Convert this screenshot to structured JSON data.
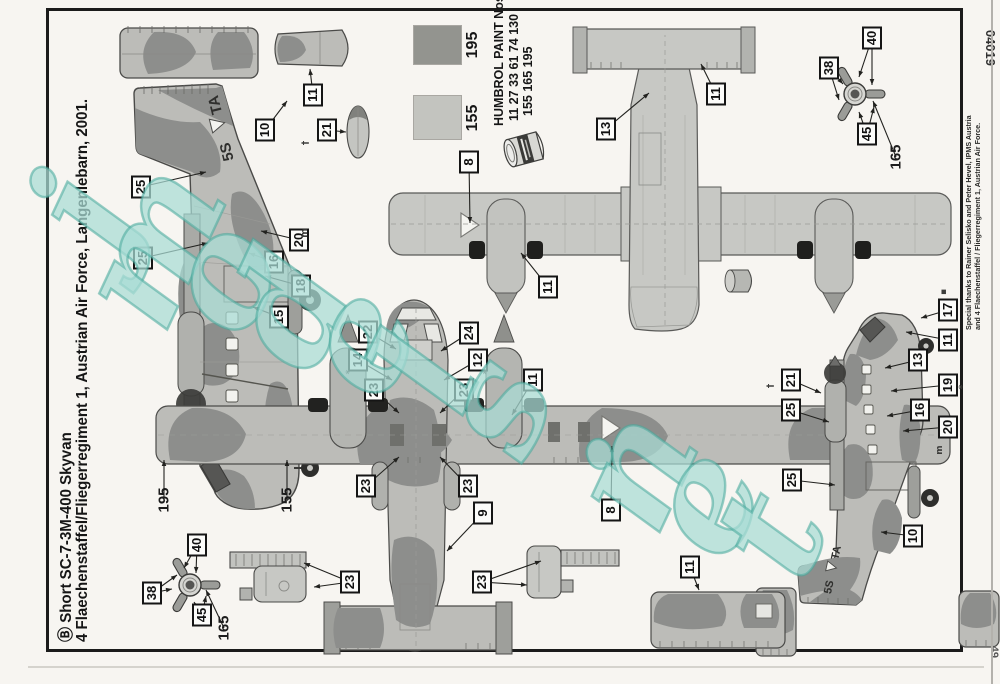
{
  "page": {
    "title_line1": "Ⓑ Short SC-7-3M-400 Skyvan",
    "title_line2": "4 Flaechenstaffel/Fliegerregiment 1, Austrian Air Force, Langenlebarn, 2001.",
    "kit_number": "04019",
    "page_number": "49",
    "registration": {
      "prefix": "5S",
      "suffix": "TA"
    }
  },
  "credits": {
    "line1": "Special thanks to Rainer Selisko and Peter Hevel, IPMS Austria",
    "line2": "and 4 Flaechenstaffel / Fliegerregiment 1, Austrian Air Force."
  },
  "paints": {
    "header": "HUMBROL PAINT Nos.",
    "numbers_line1": "11 27 33 61 74 130",
    "numbers_line2": "155 165 195",
    "swatches": [
      {
        "code": "155",
        "color": "#c3c4bf"
      },
      {
        "code": "195",
        "color": "#93948f"
      }
    ]
  },
  "watermark": {
    "text": "jmodels.net",
    "fill": "#c9ede7",
    "stroke": "#49aa9d"
  },
  "colors": {
    "paper": "#f7f5f1",
    "line": "#1b1b1b",
    "camo_dark": "#8d8e8c",
    "camo_light": "#bcbcb8",
    "underside_gray": "#c7c8c4",
    "boot_black": "#1f1f1d"
  },
  "mark_glyphs": {
    "anchor": "†",
    "sparkle": "*",
    "square": "▪",
    "m": "m"
  },
  "marks": [
    {
      "glyph": "anchor",
      "x": 541,
      "y": 306
    },
    {
      "glyph": "anchor",
      "x": 298,
      "y": 771
    },
    {
      "glyph": "sparkle",
      "x": 297,
      "y": 963
    },
    {
      "glyph": "square",
      "x": 392,
      "y": 944
    },
    {
      "glyph": "sparkle",
      "x": 312,
      "y": 350
    },
    {
      "glyph": "sparkle",
      "x": 312,
      "y": 487
    },
    {
      "glyph": "m",
      "x": 451,
      "y": 305
    },
    {
      "glyph": "m",
      "x": 234,
      "y": 940
    }
  ],
  "callout_groups": [
    {
      "name": "port-side-view",
      "items": [
        {
          "label": "10",
          "x": 554,
          "y": 265,
          "leads": [
            [
              583,
              287
            ]
          ]
        },
        {
          "label": "25",
          "x": 497,
          "y": 141,
          "leads": [
            [
              512,
              206
            ]
          ]
        },
        {
          "label": "25",
          "x": 426,
          "y": 143,
          "leads": [
            [
              441,
              208
            ]
          ]
        },
        {
          "label": "15",
          "x": 367,
          "y": 279,
          "leads": [
            [
              377,
              253
            ]
          ]
        },
        {
          "label": "16",
          "x": 422,
          "y": 274,
          "leads": [
            [
              431,
              249
            ]
          ]
        },
        {
          "label": "18",
          "x": 398,
          "y": 301,
          "leads": [
            [
              408,
              265
            ]
          ]
        },
        {
          "label": "20",
          "x": 444,
          "y": 299,
          "leads": [
            [
              453,
              261
            ]
          ]
        },
        {
          "label": "21",
          "x": 554,
          "y": 327,
          "leads": [
            [
              552,
              346
            ]
          ]
        },
        {
          "label": "11",
          "x": 589,
          "y": 313,
          "leads": [
            [
              615,
              310
            ]
          ]
        }
      ]
    },
    {
      "name": "underside-view",
      "items": [
        {
          "label": "13",
          "x": 555,
          "y": 606,
          "leads": [
            [
              591,
              649
            ]
          ]
        },
        {
          "label": "11",
          "x": 590,
          "y": 716,
          "leads": [
            [
              620,
              701
            ]
          ]
        },
        {
          "label": "8",
          "x": 522,
          "y": 469,
          "leads": [
            [
              461,
              470
            ]
          ]
        },
        {
          "label": "11",
          "x": 397,
          "y": 548,
          "leads": [
            [
              431,
              521
            ]
          ]
        }
      ]
    },
    {
      "name": "top-view",
      "items": [
        {
          "label": "22",
          "x": 352,
          "y": 368,
          "leads": [
            [
              335,
              396
            ]
          ]
        },
        {
          "label": "14",
          "x": 324,
          "y": 358,
          "leads": [
            [
              304,
              392
            ]
          ]
        },
        {
          "label": "24",
          "x": 351,
          "y": 469,
          "leads": [
            [
              333,
              441
            ]
          ]
        },
        {
          "label": "12",
          "x": 324,
          "y": 478,
          "leads": [
            [
              304,
              444
            ]
          ]
        },
        {
          "label": "23",
          "x": 294,
          "y": 374,
          "leads": [
            [
              271,
              399
            ]
          ]
        },
        {
          "label": "23",
          "x": 294,
          "y": 464,
          "leads": [
            [
              271,
              440
            ]
          ]
        },
        {
          "label": "23",
          "x": 198,
          "y": 366,
          "leads": [
            [
              227,
              399
            ]
          ]
        },
        {
          "label": "23",
          "x": 198,
          "y": 468,
          "leads": [
            [
              227,
              440
            ]
          ]
        },
        {
          "label": "9",
          "x": 171,
          "y": 483,
          "leads": [
            [
              133,
              447
            ]
          ]
        },
        {
          "label": "8",
          "x": 174,
          "y": 611,
          "leads": [
            [
              238,
              612
            ]
          ]
        },
        {
          "label": "11",
          "x": 304,
          "y": 533,
          "leads": [
            [
              269,
              512
            ]
          ]
        },
        {
          "label": "195",
          "x": 184,
          "y": 164,
          "plain": true,
          "leads": [
            [
              224,
              164
            ]
          ]
        },
        {
          "label": "155",
          "x": 184,
          "y": 287,
          "plain": true,
          "leads": [
            [
              224,
              287
            ]
          ]
        }
      ]
    },
    {
      "name": "starboard-side-view",
      "items": [
        {
          "label": "17",
          "x": 374,
          "y": 948,
          "leads": [
            [
              366,
              921
            ]
          ]
        },
        {
          "label": "11",
          "x": 344,
          "y": 948,
          "leads": [
            [
              352,
              906
            ]
          ]
        },
        {
          "label": "13",
          "x": 324,
          "y": 918,
          "leads": [
            [
              316,
              885
            ]
          ]
        },
        {
          "label": "19",
          "x": 299,
          "y": 948,
          "leads": [
            [
              293,
              891
            ]
          ]
        },
        {
          "label": "16",
          "x": 274,
          "y": 920,
          "leads": [
            [
              268,
              887
            ]
          ]
        },
        {
          "label": "20",
          "x": 257,
          "y": 948,
          "leads": [
            [
              253,
              903
            ]
          ]
        },
        {
          "label": "21",
          "x": 304,
          "y": 791,
          "leads": [
            [
              291,
              821
            ]
          ]
        },
        {
          "label": "25",
          "x": 274,
          "y": 791,
          "leads": [
            [
              262,
              829
            ]
          ]
        },
        {
          "label": "25",
          "x": 204,
          "y": 792,
          "leads": [
            [
              199,
              835
            ]
          ]
        },
        {
          "label": "10",
          "x": 148,
          "y": 913,
          "leads": [
            [
              152,
              881
            ]
          ]
        }
      ]
    },
    {
      "name": "propeller-front-upper",
      "items": [
        {
          "label": "38",
          "x": 616,
          "y": 829,
          "leads": [
            [
              600,
              843
            ],
            [
              584,
              839
            ]
          ]
        },
        {
          "label": "40",
          "x": 646,
          "y": 872,
          "leads": [
            [
              607,
              859
            ],
            [
              599,
              872
            ]
          ]
        },
        {
          "label": "45",
          "x": 550,
          "y": 867,
          "leads": [
            [
              572,
              859
            ],
            [
              577,
              874
            ]
          ]
        },
        {
          "label": "165",
          "x": 527,
          "y": 896,
          "plain": true,
          "leads": [
            [
              583,
              873
            ]
          ]
        }
      ]
    },
    {
      "name": "propeller-front-lower",
      "items": [
        {
          "label": "38",
          "x": 91,
          "y": 152,
          "leads": [
            [
              95,
              172
            ],
            [
              109,
              177
            ]
          ]
        },
        {
          "label": "40",
          "x": 139,
          "y": 197,
          "leads": [
            [
              116,
              184
            ],
            [
              111,
              196
            ]
          ]
        },
        {
          "label": "45",
          "x": 69,
          "y": 202,
          "leads": [
            [
              82,
              194
            ],
            [
              88,
              206
            ]
          ]
        },
        {
          "label": "165",
          "x": 56,
          "y": 224,
          "plain": true,
          "leads": [
            [
              94,
              206
            ]
          ]
        }
      ]
    },
    {
      "name": "sponson-details",
      "items": [
        {
          "label": "23",
          "x": 102,
          "y": 350,
          "leads": [
            [
              97,
              314
            ],
            [
              121,
              304
            ]
          ]
        },
        {
          "label": "23",
          "x": 102,
          "y": 482,
          "leads": [
            [
              99,
              527
            ],
            [
              123,
              541
            ]
          ]
        }
      ]
    },
    {
      "name": "fin-piece",
      "items": [
        {
          "label": "11",
          "x": 117,
          "y": 690,
          "leads": [
            [
              94,
              699
            ]
          ]
        }
      ]
    }
  ]
}
